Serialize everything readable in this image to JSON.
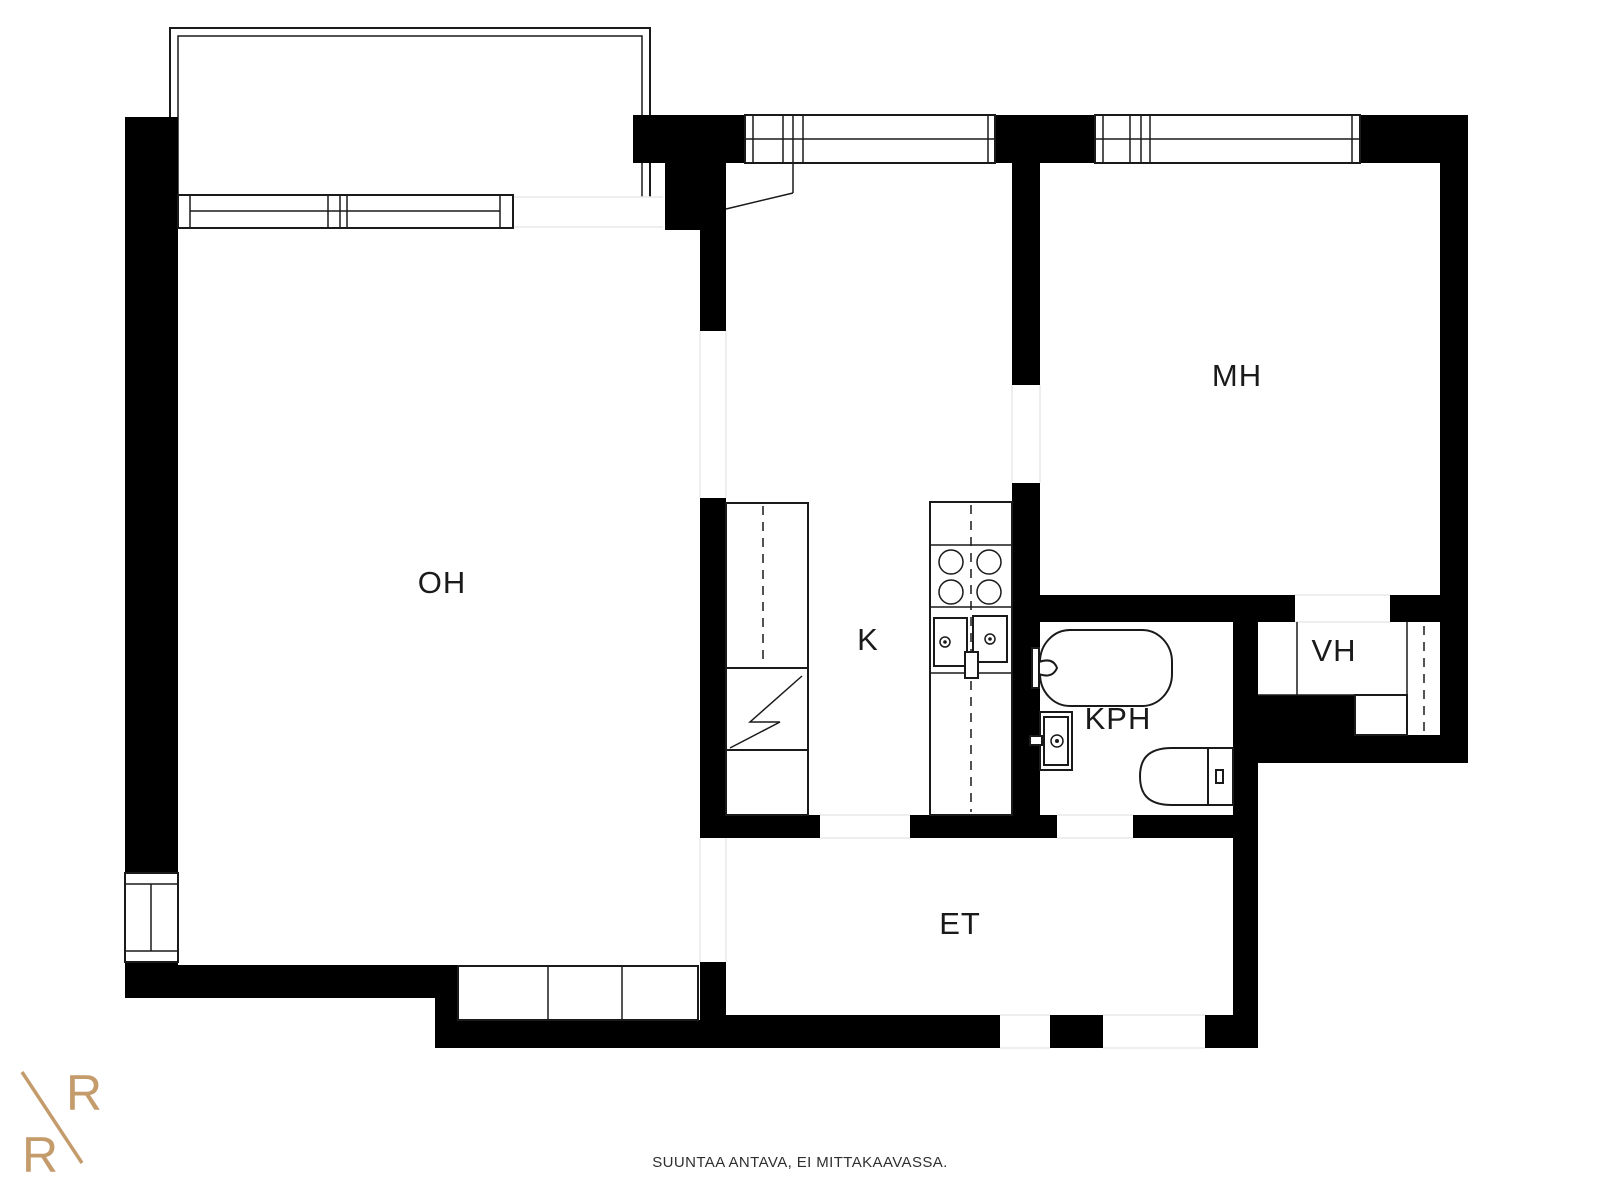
{
  "plan": {
    "type": "apartment-floor-plan",
    "rooms": [
      {
        "id": "oh",
        "label": "OH"
      },
      {
        "id": "k",
        "label": "K"
      },
      {
        "id": "mh",
        "label": "MH"
      },
      {
        "id": "vh",
        "label": "VH"
      },
      {
        "id": "kph",
        "label": "KPH"
      },
      {
        "id": "et",
        "label": "ET"
      }
    ],
    "fixtures": [
      "balcony",
      "window",
      "tall-cabinet",
      "kitchen-counter",
      "stove-burners",
      "kitchen-sink",
      "bathtub",
      "washbasin",
      "toilet",
      "wardrobe-cabinets"
    ]
  },
  "footer": {
    "disclaimer": "SUUNTAA ANTAVA, EI MITTAKAAVASSA."
  },
  "logo": {
    "letter_top": "R",
    "letter_bottom": "R",
    "color": "#C49B6B"
  },
  "colors": {
    "background": "#ffffff",
    "wall": "#000000",
    "line": "#1a1a1a",
    "opening_line": "#e8e8e8",
    "label": "#1a1a1a"
  }
}
